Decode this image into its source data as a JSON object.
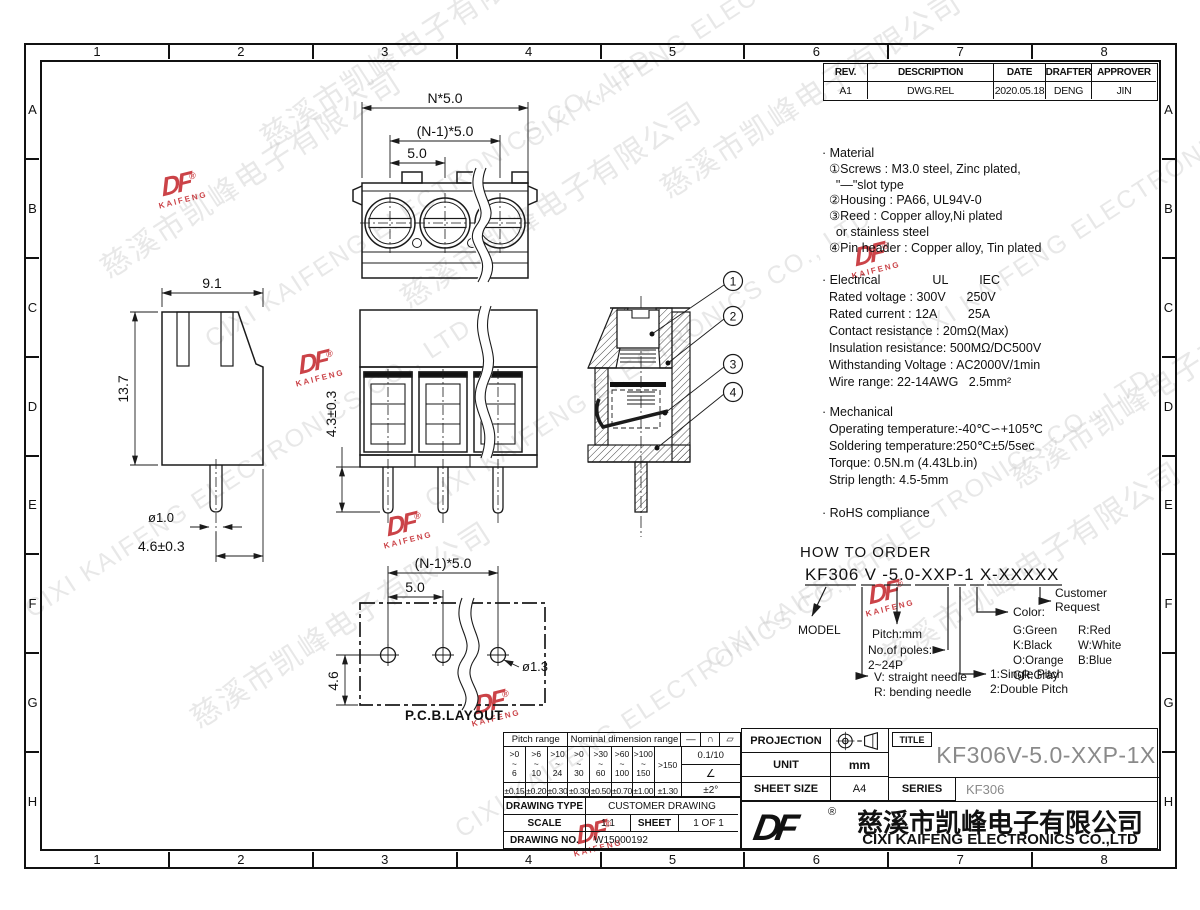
{
  "frame": {
    "columns": [
      "1",
      "2",
      "3",
      "4",
      "5",
      "6",
      "7",
      "8"
    ],
    "rows": [
      "A",
      "B",
      "C",
      "D",
      "E",
      "F",
      "G",
      "H"
    ]
  },
  "revision_table": {
    "headers": [
      "REV.",
      "DESCRIPTION",
      "DATE",
      "DRAFTER",
      "APPROVER"
    ],
    "row": {
      "rev": "A1",
      "description": "DWG.REL",
      "date": "2020.05.18",
      "drafter": "DENG",
      "approver": "JIN"
    }
  },
  "notes": {
    "material": "· Material\n  ①Screws : M3.0 steel, Zinc plated,\n    \"—\"slot type\n  ②Housing : PA66, UL94V-0\n  ③Reed : Copper alloy,Ni plated\n    or stainless steel\n  ④Pin header : Copper alloy, Tin plated",
    "electrical": "· Electrical               UL         IEC\n  Rated voltage : 300V      250V\n  Rated current : 12A         25A\n  Contact resistance : 20mΩ(Max)\n  Insulation resistance: 500MΩ/DC500V\n  Withstanding Voltage : AC2000V/1min\n  Wire range: 22-14AWG   2.5mm²",
    "mechanical": "· Mechanical\n  Operating temperature:-40℃∽+105℃\n  Soldering temperature:250℃±5/5sec\n  Torque: 0.5N.m (4.43Lb.in)\n  Strip length: 4.5-5mm",
    "rohs": "· RoHS compliance"
  },
  "how_to_order": {
    "title": "HOW TO ORDER",
    "code": "KF306 V -5.0-XXP-1 X-XXXXX",
    "model_label": "MODEL",
    "needle_label1": "V: straight needle",
    "needle_label2": "R: bending needle",
    "pitch_label": "Pitch:mm",
    "poles_label": "No.of poles:",
    "poles_range": "2~24P",
    "pitch_type1": "1:Single Pitch",
    "pitch_type2": "2:Double Pitch",
    "color_label": "Color:",
    "colors": [
      "G:Green",
      "K:Black",
      "O:Orange",
      "GR:Gray",
      "R:Red",
      "W:White",
      "B:Blue"
    ],
    "customer1": "Customer",
    "customer2": "Request"
  },
  "dimensions": {
    "top_view": {
      "d1": "N*5.0",
      "d2": "(N-1)*5.0",
      "d3": "5.0"
    },
    "side_view": {
      "w": "9.1",
      "h": "13.7",
      "pin": "ø1.0",
      "pin_len": "4.6±0.3"
    },
    "front_view": {
      "pin_len": "4.3±0.3"
    },
    "pcb": {
      "d1": "(N-1)*5.0",
      "d2": "5.0",
      "h": "4.6",
      "hole": "ø1.3",
      "label": "P.C.B.LAYOUT"
    },
    "callouts": [
      "1",
      "2",
      "3",
      "4"
    ]
  },
  "tolerance_table": {
    "pitch_header": "Pitch range",
    "nominal_header": "Nominal dimension range",
    "symbols": [
      "—",
      "∩",
      "▱"
    ],
    "ranges": [
      ">0\n~\n6",
      ">6\n~\n10",
      ">10\n~\n24",
      ">0\n~\n30",
      ">30\n~\n60",
      ">60\n~\n100",
      ">100\n~\n150",
      ">150"
    ],
    "ratio": "0.1/10",
    "angle_symbol": "∠",
    "tolerances": [
      "±0.15",
      "±0.20",
      "±0.30",
      "±0.30",
      "±0.50",
      "±0.70",
      "±1.00",
      "±1.30"
    ],
    "angle_tol": "±2°"
  },
  "drawing_info": {
    "type_label": "DRAWING TYPE",
    "type_value": "CUSTOMER DRAWING",
    "scale_label": "SCALE",
    "scale_value": "1:1",
    "sheet_label": "SHEET",
    "sheet_value": "1 OF 1",
    "no_label": "DRAWING NO.",
    "no_value": "W15000192"
  },
  "title_block": {
    "projection_label": "PROJECTION",
    "unit_label": "UNIT",
    "unit_value": "mm",
    "sheet_size_label": "SHEET SIZE",
    "sheet_size_value": "A4",
    "title_label": "TITLE",
    "title_value": "KF306V-5.0-XXP-1X",
    "series_label": "SERIES",
    "series_value": "KF306"
  },
  "company": {
    "logo_text": "DF",
    "logo_reg": "®",
    "logo_sub": "KAIFENG",
    "name_cn": "慈溪市凯峰电子有限公司",
    "name_en": "CIXI KAIFENG ELECTRONICS CO.,LTD"
  },
  "watermark": {
    "cn": "慈溪市凯峰电子有限公司",
    "en": "CIXI KAIFENG ELECTRONICS CO., LTD"
  },
  "colors": {
    "line": "#1b1b1b",
    "title_gray": "#8a8a8a",
    "stamp_red": "#c42a2f",
    "watermark_gray": "#c3c3c3"
  }
}
